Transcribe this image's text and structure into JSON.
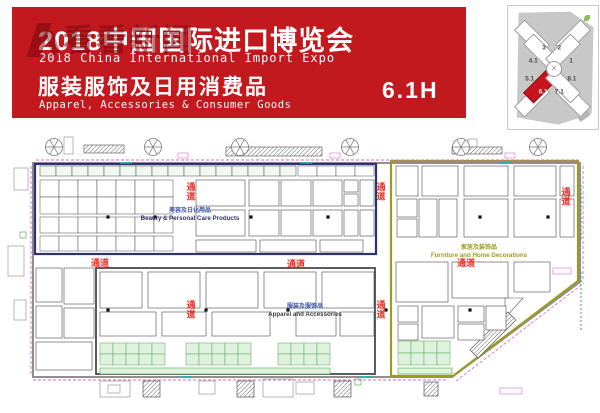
{
  "banner": {
    "title_cn": "2018中国国际进口博览会",
    "title_en": "2018 China International Import Expo",
    "subtitle_cn": "服装服饰及日用消费品",
    "subtitle_en": "Apparel, Accessories & Consumer Goods",
    "hall_code": "6.1H",
    "watermark": "看看新闻",
    "bg_color": "#c2191f"
  },
  "minimap": {
    "highlight_hall": "6.1",
    "highlight_color": "#c8141c",
    "center_glyph": "✕",
    "halls": [
      {
        "label": "3",
        "x": 40,
        "y": 34,
        "hl": false
      },
      {
        "label": "2",
        "x": 57,
        "y": 34,
        "hl": false
      },
      {
        "label": "4.1",
        "x": 28,
        "y": 45,
        "hl": false
      },
      {
        "label": "1",
        "x": 70,
        "y": 45,
        "hl": false
      },
      {
        "label": "5.1",
        "x": 24,
        "y": 59,
        "hl": false
      },
      {
        "label": "8.1",
        "x": 71,
        "y": 59,
        "hl": false
      },
      {
        "label": "6.1",
        "x": 39,
        "y": 70,
        "hl": true
      },
      {
        "label": "7.1",
        "x": 57,
        "y": 70,
        "hl": false
      }
    ],
    "wings": [
      {
        "cx": 25,
        "cy": 25,
        "rot": 45,
        "red": false
      },
      {
        "cx": 36,
        "cy": 36,
        "rot": 45,
        "red": false
      },
      {
        "cx": 71,
        "cy": 25,
        "rot": -45,
        "red": false
      },
      {
        "cx": 60,
        "cy": 36,
        "rot": -45,
        "red": false
      },
      {
        "cx": 25,
        "cy": 75,
        "rot": -45,
        "red": false
      },
      {
        "cx": 36,
        "cy": 64,
        "rot": -45,
        "red": true
      },
      {
        "cx": 71,
        "cy": 75,
        "rot": 45,
        "red": false
      },
      {
        "cx": 60,
        "cy": 64,
        "rot": 45,
        "red": false
      }
    ]
  },
  "plan": {
    "aisle_label": "通道",
    "sections": [
      {
        "name_cn": "美容及日化用品",
        "name_en": "Beauty & Personal Care Products",
        "color": "#2e3174"
      },
      {
        "name_cn": "服装及服饰品",
        "name_en": "Apparel and Accessories",
        "color": "#4a4a4a"
      },
      {
        "name_cn": "家居及装饰品",
        "name_en": "Furniture and Home Decorations",
        "color": "#9b9b23"
      }
    ],
    "polys": [
      {
        "pts": "33,163 580,163 580,282 452,377 33,377",
        "s": "#8f8f8f",
        "w": 2,
        "n": "hall-wall"
      },
      {
        "pts": "391,161 578,161 578,281 453,376 391,376",
        "s": "#9b9b23",
        "w": 2.2,
        "n": "section-furniture-border"
      },
      {
        "pts": "505,298 523,298 505,318",
        "s": "#555555",
        "w": 0.6,
        "f": "#ffffff",
        "n": "booth"
      },
      {
        "pts": "470,350 508,312 516,320 478,358",
        "s": "#555555",
        "w": 0.7,
        "f": "url(#hatch)",
        "n": "escalator"
      }
    ],
    "rects": [
      {
        "x": 35,
        "y": 164,
        "w": 341,
        "h": 90,
        "s": "#2e3174",
        "sw": 2.2,
        "f": "none",
        "n": "section-beauty-border"
      },
      {
        "x": 96,
        "y": 268,
        "w": 279,
        "h": 106,
        "s": "#4a4a4a",
        "sw": 1.8,
        "f": "none",
        "n": "section-apparel-border"
      },
      {
        "x": 196,
        "y": 180,
        "w": 49,
        "h": 26
      },
      {
        "x": 249,
        "y": 180,
        "w": 30,
        "h": 26
      },
      {
        "x": 281,
        "y": 180,
        "w": 30,
        "h": 26
      },
      {
        "x": 313,
        "y": 180,
        "w": 29,
        "h": 26
      },
      {
        "x": 344,
        "y": 180,
        "w": 14,
        "h": 12
      },
      {
        "x": 344,
        "y": 194,
        "w": 14,
        "h": 12
      },
      {
        "x": 360,
        "y": 180,
        "w": 14,
        "h": 26
      },
      {
        "x": 196,
        "y": 210,
        "w": 49,
        "h": 26
      },
      {
        "x": 249,
        "y": 210,
        "w": 30,
        "h": 26
      },
      {
        "x": 281,
        "y": 210,
        "w": 30,
        "h": 26
      },
      {
        "x": 313,
        "y": 210,
        "w": 29,
        "h": 26
      },
      {
        "x": 344,
        "y": 210,
        "w": 14,
        "h": 26
      },
      {
        "x": 360,
        "y": 210,
        "w": 14,
        "h": 26
      },
      {
        "x": 196,
        "y": 240,
        "w": 60,
        "h": 12
      },
      {
        "x": 260,
        "y": 240,
        "w": 56,
        "h": 12
      },
      {
        "x": 320,
        "y": 240,
        "w": 43,
        "h": 12
      },
      {
        "x": 36,
        "y": 268,
        "w": 26,
        "h": 34
      },
      {
        "x": 36,
        "y": 306,
        "w": 26,
        "h": 32
      },
      {
        "x": 64,
        "y": 268,
        "w": 30,
        "h": 36
      },
      {
        "x": 64,
        "y": 308,
        "w": 30,
        "h": 30
      },
      {
        "x": 36,
        "y": 342,
        "w": 56,
        "h": 28
      },
      {
        "x": 100,
        "y": 272,
        "w": 42,
        "h": 36
      },
      {
        "x": 148,
        "y": 272,
        "w": 52,
        "h": 36
      },
      {
        "x": 206,
        "y": 272,
        "w": 52,
        "h": 36
      },
      {
        "x": 264,
        "y": 272,
        "w": 52,
        "h": 36
      },
      {
        "x": 322,
        "y": 272,
        "w": 52,
        "h": 36
      },
      {
        "x": 100,
        "y": 312,
        "w": 56,
        "h": 24
      },
      {
        "x": 162,
        "y": 312,
        "w": 44,
        "h": 24
      },
      {
        "x": 212,
        "y": 312,
        "w": 58,
        "h": 24
      },
      {
        "x": 296,
        "y": 312,
        "w": 40,
        "h": 24
      },
      {
        "x": 340,
        "y": 312,
        "w": 34,
        "h": 24
      },
      {
        "x": 396,
        "y": 166,
        "w": 22,
        "h": 30
      },
      {
        "x": 422,
        "y": 166,
        "w": 36,
        "h": 30
      },
      {
        "x": 464,
        "y": 166,
        "w": 44,
        "h": 30
      },
      {
        "x": 514,
        "y": 166,
        "w": 42,
        "h": 30
      },
      {
        "x": 560,
        "y": 166,
        "w": 14,
        "h": 30
      },
      {
        "x": 397,
        "y": 199,
        "w": 20,
        "h": 18
      },
      {
        "x": 397,
        "y": 219,
        "w": 20,
        "h": 18
      },
      {
        "x": 419,
        "y": 199,
        "w": 18,
        "h": 38
      },
      {
        "x": 439,
        "y": 199,
        "w": 18,
        "h": 38
      },
      {
        "x": 464,
        "y": 199,
        "w": 44,
        "h": 38
      },
      {
        "x": 514,
        "y": 199,
        "w": 42,
        "h": 38
      },
      {
        "x": 560,
        "y": 199,
        "w": 14,
        "h": 38
      },
      {
        "x": 396,
        "y": 262,
        "w": 52,
        "h": 40
      },
      {
        "x": 452,
        "y": 262,
        "w": 56,
        "h": 36
      },
      {
        "x": 514,
        "y": 262,
        "w": 36,
        "h": 30
      },
      {
        "x": 398,
        "y": 306,
        "w": 20,
        "h": 16
      },
      {
        "x": 398,
        "y": 324,
        "w": 20,
        "h": 16
      },
      {
        "x": 422,
        "y": 306,
        "w": 32,
        "h": 32
      },
      {
        "x": 458,
        "y": 306,
        "w": 26,
        "h": 16
      },
      {
        "x": 458,
        "y": 324,
        "w": 26,
        "h": 16
      },
      {
        "x": 486,
        "y": 306,
        "w": 20,
        "h": 24
      },
      {
        "x": 100,
        "y": 368,
        "w": 230,
        "h": 6,
        "f": "#def2de",
        "s": "#57a657",
        "sw": 0.6,
        "n": "green-strip"
      },
      {
        "x": 398,
        "y": 368,
        "w": 54,
        "h": 6,
        "f": "#def2de",
        "s": "#57a657",
        "sw": 0.6,
        "n": "green-strip"
      },
      {
        "x": 64,
        "y": 137,
        "w": 9,
        "h": 17,
        "s": "#888888",
        "n": "facility"
      },
      {
        "x": 468,
        "y": 139,
        "w": 9,
        "h": 13,
        "s": "#888888",
        "n": "facility"
      },
      {
        "x": 84,
        "y": 145,
        "w": 40,
        "h": 8,
        "f": "url(#hatch)",
        "s": "#666666",
        "sw": 0.7,
        "n": "air-duct"
      },
      {
        "x": 226,
        "y": 147,
        "w": 96,
        "h": 9,
        "f": "url(#hatch)",
        "s": "#666666",
        "sw": 0.7,
        "n": "air-duct"
      },
      {
        "x": 452,
        "y": 147,
        "w": 50,
        "h": 7,
        "f": "url(#hatch)",
        "s": "#666666",
        "sw": 0.7,
        "n": "air-duct"
      },
      {
        "x": 100,
        "y": 381,
        "w": 30,
        "h": 16,
        "s": "#888888",
        "n": "facility"
      },
      {
        "x": 108,
        "y": 385,
        "w": 12,
        "h": 8,
        "s": "#888888",
        "n": "facility"
      },
      {
        "x": 199,
        "y": 381,
        "w": 16,
        "h": 13,
        "s": "#888888",
        "n": "facility"
      },
      {
        "x": 263,
        "y": 379,
        "w": 30,
        "h": 18,
        "s": "#888888",
        "n": "facility"
      },
      {
        "x": 296,
        "y": 382,
        "w": 18,
        "h": 12,
        "s": "#888888",
        "n": "facility"
      },
      {
        "x": 143,
        "y": 381,
        "w": 17,
        "h": 16,
        "f": "url(#hatch)",
        "s": "#555555",
        "sw": 0.7,
        "n": "escalator"
      },
      {
        "x": 237,
        "y": 381,
        "w": 17,
        "h": 16,
        "f": "url(#hatch)",
        "s": "#555555",
        "sw": 0.7,
        "n": "escalator"
      },
      {
        "x": 334,
        "y": 381,
        "w": 17,
        "h": 16,
        "f": "url(#hatch)",
        "s": "#555555",
        "sw": 0.7,
        "n": "escalator"
      },
      {
        "x": 424,
        "y": 382,
        "w": 14,
        "h": 14,
        "f": "url(#hatch)",
        "s": "#555555",
        "sw": 0.7,
        "n": "escalator"
      },
      {
        "x": 14,
        "y": 168,
        "w": 14,
        "h": 22,
        "s": "#888888",
        "n": "facility"
      },
      {
        "x": 8,
        "y": 246,
        "w": 16,
        "h": 30,
        "s": "#888888",
        "n": "facility"
      },
      {
        "x": 14,
        "y": 300,
        "w": 12,
        "h": 20,
        "s": "#888888",
        "n": "facility"
      },
      {
        "x": 178,
        "y": 153,
        "w": 10,
        "h": 5,
        "s": "#e066cc",
        "f": "none",
        "n": "door-mark"
      },
      {
        "x": 330,
        "y": 153,
        "w": 10,
        "h": 5,
        "s": "#e066cc",
        "f": "none",
        "n": "door-mark"
      },
      {
        "x": 505,
        "y": 153,
        "w": 10,
        "h": 5,
        "s": "#e066cc",
        "f": "none",
        "n": "door-mark"
      },
      {
        "x": 553,
        "y": 268,
        "w": 18,
        "h": 6,
        "s": "#e066cc",
        "f": "none",
        "n": "door-mark"
      },
      {
        "x": 500,
        "y": 388,
        "w": 22,
        "h": 6,
        "s": "#e066cc",
        "f": "none",
        "n": "door-mark"
      },
      {
        "x": 20,
        "y": 232,
        "w": 6,
        "h": 6,
        "s": "#3aa43a",
        "f": "none",
        "n": "exit-mark"
      },
      {
        "x": 355,
        "y": 379,
        "w": 6,
        "h": 6,
        "s": "#3aa43a",
        "f": "none",
        "n": "exit-mark"
      }
    ],
    "grids": [
      {
        "x": 40,
        "y": 166,
        "cols": 16,
        "cw": 16,
        "rows": 1,
        "ch": 10,
        "f": "#f0f8f0"
      },
      {
        "x": 298,
        "y": 166,
        "cols": 4,
        "cw": 19,
        "rows": 1,
        "ch": 10,
        "f": "#ffffff"
      },
      {
        "x": 40,
        "y": 180,
        "cols": 7,
        "cw": 19,
        "rows": 2,
        "ch": 17,
        "f": "#ffffff"
      },
      {
        "x": 40,
        "y": 217,
        "cols": 7,
        "cw": 19,
        "rows": 1,
        "ch": 16,
        "f": "#ffffff"
      },
      {
        "x": 40,
        "y": 236,
        "cols": 7,
        "cw": 19,
        "rows": 1,
        "ch": 15,
        "f": "#ffffff"
      },
      {
        "x": 100,
        "y": 343,
        "cols": 5,
        "cw": 13,
        "rows": 2,
        "ch": 11,
        "f": "#def2de",
        "s": "#57a657"
      },
      {
        "x": 186,
        "y": 343,
        "cols": 5,
        "cw": 13,
        "rows": 2,
        "ch": 11,
        "f": "#def2de",
        "s": "#57a657"
      },
      {
        "x": 278,
        "y": 343,
        "cols": 4,
        "cw": 13,
        "rows": 2,
        "ch": 11,
        "f": "#def2de",
        "s": "#57a657"
      },
      {
        "x": 398,
        "y": 341,
        "cols": 4,
        "cw": 13,
        "rows": 2,
        "ch": 12,
        "f": "#def2de",
        "s": "#57a657"
      }
    ],
    "lines": [
      {
        "x1": 36,
        "y1": 160,
        "x2": 578,
        "y2": 160,
        "s": "#e066cc",
        "w": 0.9,
        "d": "3,2"
      },
      {
        "x1": 31,
        "y1": 166,
        "x2": 31,
        "y2": 375,
        "s": "#e066cc",
        "w": 0.9,
        "d": "3,2"
      },
      {
        "x1": 33,
        "y1": 380,
        "x2": 448,
        "y2": 380,
        "s": "#e066cc",
        "w": 0.9,
        "d": "3,2"
      },
      {
        "x1": 456,
        "y1": 381,
        "x2": 584,
        "y2": 283,
        "s": "#e066cc",
        "w": 0.9,
        "d": "3,2"
      },
      {
        "x1": 583,
        "y1": 166,
        "x2": 583,
        "y2": 280,
        "s": "#e066cc",
        "w": 0.9,
        "d": "3,2"
      },
      {
        "x1": 120,
        "y1": 163,
        "x2": 132,
        "y2": 163,
        "s": "#18b5b5",
        "w": 1.4
      },
      {
        "x1": 300,
        "y1": 163,
        "x2": 312,
        "y2": 163,
        "s": "#18b5b5",
        "w": 1.4
      },
      {
        "x1": 500,
        "y1": 163,
        "x2": 512,
        "y2": 163,
        "s": "#18b5b5",
        "w": 1.4
      },
      {
        "x1": 180,
        "y1": 377,
        "x2": 192,
        "y2": 377,
        "s": "#18b5b5",
        "w": 1.4
      },
      {
        "x1": 360,
        "y1": 377,
        "x2": 372,
        "y2": 377,
        "s": "#18b5b5",
        "w": 1.4
      },
      {
        "x1": 581,
        "y1": 185,
        "x2": 581,
        "y2": 240,
        "s": "#3aa43a",
        "w": 1,
        "d": "2,2"
      },
      {
        "x1": 581,
        "y1": 272,
        "x2": 581,
        "y2": 330,
        "s": "#3aa43a",
        "w": 1,
        "d": "2,2"
      }
    ],
    "fans": {
      "cy": 147,
      "r": 8.5,
      "xs": [
        54,
        153,
        240,
        350,
        461,
        538
      ]
    },
    "columns": {
      "size": 3.2,
      "pts": [
        [
          108,
          217
        ],
        [
          155,
          217
        ],
        [
          251,
          217
        ],
        [
          328,
          217
        ],
        [
          480,
          217
        ],
        [
          548,
          217
        ],
        [
          108,
          310
        ],
        [
          206,
          310
        ],
        [
          288,
          310
        ],
        [
          386,
          310
        ],
        [
          470,
          310
        ]
      ]
    },
    "texts": [
      {
        "x": 190,
        "y": 212,
        "t": "美容及日化用品",
        "c": "#3c50a8",
        "s": 6,
        "b": 1
      },
      {
        "x": 190,
        "y": 220,
        "t": "Beauty & Personal Care Products",
        "c": "#2e3174",
        "s": 6.2,
        "b": 1
      },
      {
        "x": 305,
        "y": 308,
        "t": "服装及服饰品",
        "c": "#3c50a8",
        "s": 6,
        "b": 1
      },
      {
        "x": 305,
        "y": 316,
        "t": "Apparel and Accessories",
        "c": "#3f3f3f",
        "s": 6.2,
        "b": 1
      },
      {
        "x": 479,
        "y": 249,
        "t": "家居及装饰品",
        "c": "#9b9b23",
        "s": 6,
        "b": 1
      },
      {
        "x": 479,
        "y": 257,
        "t": "Furniture and Home Decorations",
        "c": "#9b9b23",
        "s": 6.2,
        "b": 1
      },
      {
        "x": 100,
        "y": 266,
        "t": "通道",
        "c": "#e8312a",
        "s": 9,
        "b": 1
      },
      {
        "x": 296,
        "y": 267,
        "t": "通道",
        "c": "#e8312a",
        "s": 9,
        "b": 1
      },
      {
        "x": 466,
        "y": 266,
        "t": "通道",
        "c": "#e8312a",
        "s": 9,
        "b": 1
      },
      {
        "x": 191,
        "y": 190,
        "t": "通道",
        "c": "#e8312a",
        "s": 9,
        "b": 1,
        "v": 1
      },
      {
        "x": 381,
        "y": 190,
        "t": "通道",
        "c": "#e8312a",
        "s": 9,
        "b": 1,
        "v": 1
      },
      {
        "x": 566,
        "y": 195,
        "t": "通道",
        "c": "#e8312a",
        "s": 9,
        "b": 1,
        "v": 1
      },
      {
        "x": 191,
        "y": 308,
        "t": "通道",
        "c": "#e8312a",
        "s": 9,
        "b": 1,
        "v": 1
      },
      {
        "x": 381,
        "y": 308,
        "t": "通道",
        "c": "#e8312a",
        "s": 9,
        "b": 1,
        "v": 1
      }
    ]
  }
}
